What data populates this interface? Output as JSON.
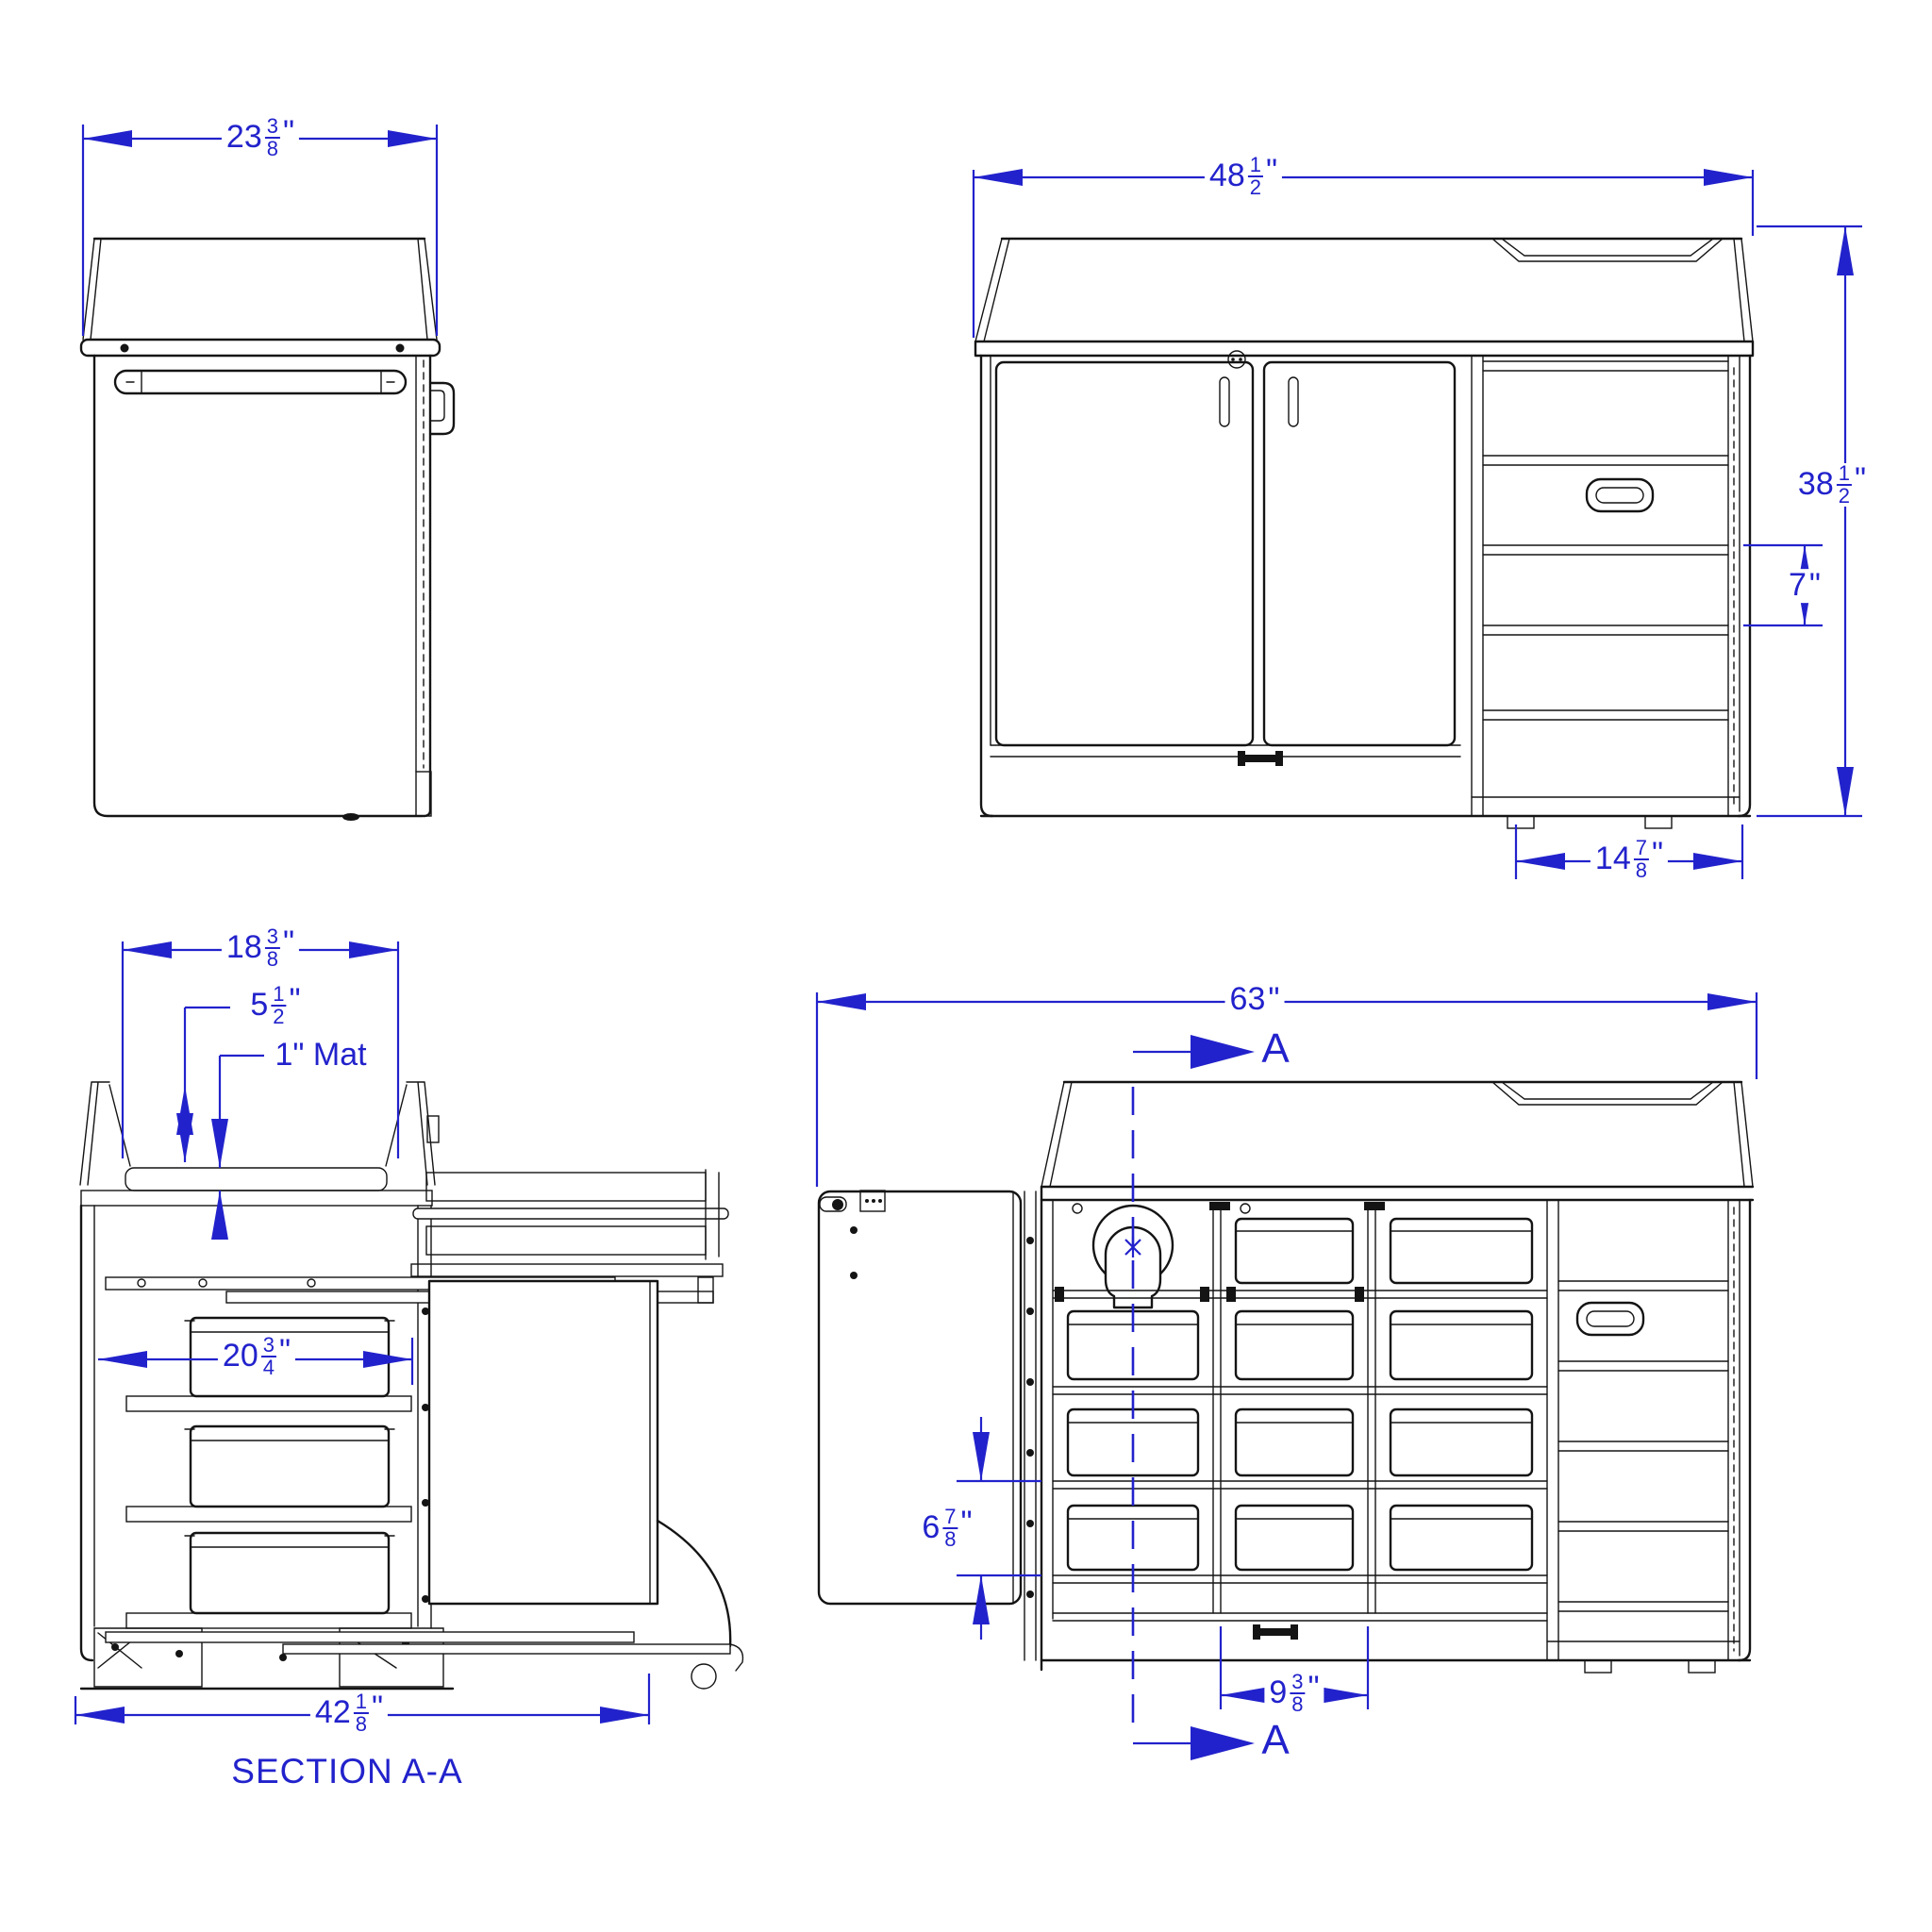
{
  "drawing": {
    "accent_color": "#2222cc",
    "line_color": "#141414",
    "section_title": "SECTION A-A",
    "section_label": "A"
  },
  "dimensions": {
    "side_width": {
      "whole": "23",
      "num": "3",
      "den": "8",
      "unit": "\""
    },
    "front_width": {
      "whole": "48",
      "num": "1",
      "den": "2",
      "unit": "\""
    },
    "front_height": {
      "whole": "38",
      "num": "1",
      "den": "2",
      "unit": "\""
    },
    "step_rise": {
      "whole": "7",
      "unit": "\""
    },
    "steps_depth": {
      "whole": "14",
      "num": "7",
      "den": "8",
      "unit": "\""
    },
    "tray_width": {
      "whole": "18",
      "num": "3",
      "den": "8",
      "unit": "\""
    },
    "tray_depth": {
      "whole": "5",
      "num": "1",
      "den": "2",
      "unit": "\""
    },
    "mat_note": {
      "label": "1\" Mat"
    },
    "bin_width": {
      "whole": "20",
      "num": "3",
      "den": "4",
      "unit": "\""
    },
    "section_width": {
      "whole": "42",
      "num": "1",
      "den": "8",
      "unit": "\""
    },
    "overall_width": {
      "whole": "63",
      "unit": "\""
    },
    "shelf_spacing": {
      "whole": "6",
      "num": "7",
      "den": "8",
      "unit": "\""
    },
    "bin_spacing": {
      "whole": "9",
      "num": "3",
      "den": "8",
      "unit": "\""
    }
  }
}
